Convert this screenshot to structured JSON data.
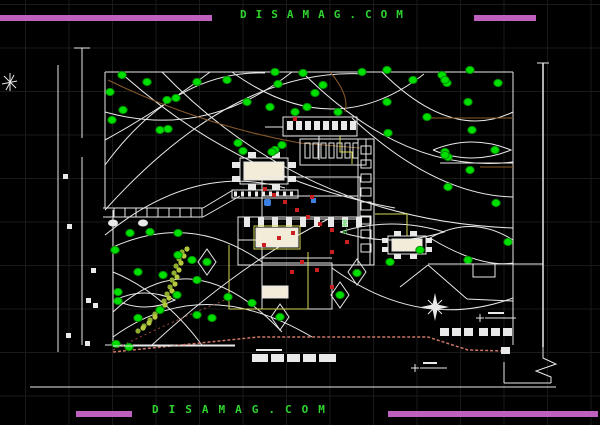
{
  "watermark": {
    "top_text": "DISAMAG.COM",
    "bottom_text": "DISAMAG.COM"
  },
  "labels": {
    "elevation_text": "0.00"
  },
  "colors": {
    "background": "#000000",
    "grid": "#1a1a1a",
    "line_white": "#e9e9e9",
    "magenta_bar": "#c060be",
    "watermark_green": "#2fd32f",
    "tree_green": "#00e000",
    "yellow_boundary": "#d8d855",
    "cream_fill": "#f2ecd8",
    "red_fixture": "#cc2020",
    "salmon_contour": "#cc7766",
    "brown_road": "#8b5a2b",
    "blue_fixture": "#3b7fe0"
  },
  "plan": {
    "trees": [
      [
        122,
        75
      ],
      [
        147,
        82
      ],
      [
        167,
        100
      ],
      [
        176,
        98
      ],
      [
        197,
        82
      ],
      [
        227,
        80
      ],
      [
        247,
        102
      ],
      [
        110,
        92
      ],
      [
        123,
        110
      ],
      [
        112,
        120
      ],
      [
        160,
        130
      ],
      [
        168,
        129
      ],
      [
        238,
        143
      ],
      [
        270,
        107
      ],
      [
        275,
        72
      ],
      [
        278,
        84
      ],
      [
        303,
        73
      ],
      [
        315,
        93
      ],
      [
        323,
        85
      ],
      [
        338,
        112
      ],
      [
        295,
        112
      ],
      [
        307,
        107
      ],
      [
        362,
        72
      ],
      [
        387,
        70
      ],
      [
        387,
        102
      ],
      [
        413,
        80
      ],
      [
        427,
        117
      ],
      [
        442,
        75
      ],
      [
        447,
        83
      ],
      [
        388,
        133
      ],
      [
        445,
        152
      ],
      [
        448,
        157
      ],
      [
        282,
        145
      ],
      [
        275,
        150
      ],
      [
        470,
        70
      ],
      [
        445,
        80
      ],
      [
        498,
        83
      ],
      [
        468,
        102
      ],
      [
        472,
        130
      ],
      [
        445,
        155
      ],
      [
        495,
        150
      ],
      [
        470,
        170
      ],
      [
        448,
        187
      ],
      [
        496,
        203
      ],
      [
        508,
        242
      ],
      [
        243,
        151
      ],
      [
        272,
        152
      ],
      [
        357,
        273
      ],
      [
        340,
        295
      ],
      [
        280,
        317
      ],
      [
        252,
        303
      ],
      [
        390,
        262
      ],
      [
        420,
        250
      ],
      [
        468,
        260
      ],
      [
        130,
        233
      ],
      [
        150,
        232
      ],
      [
        178,
        233
      ],
      [
        115,
        250
      ],
      [
        138,
        272
      ],
      [
        163,
        275
      ],
      [
        118,
        292
      ],
      [
        118,
        301
      ],
      [
        138,
        318
      ],
      [
        178,
        255
      ],
      [
        192,
        260
      ],
      [
        177,
        295
      ],
      [
        197,
        280
      ],
      [
        207,
        262
      ],
      [
        228,
        297
      ],
      [
        197,
        315
      ],
      [
        212,
        318
      ],
      [
        116,
        344
      ],
      [
        129,
        347
      ],
      [
        160,
        310
      ]
    ],
    "red_fixtures": [
      [
        263,
        187
      ],
      [
        272,
        193
      ],
      [
        283,
        200
      ],
      [
        295,
        208
      ],
      [
        306,
        215
      ],
      [
        318,
        222
      ],
      [
        330,
        228
      ],
      [
        291,
        231
      ],
      [
        277,
        236
      ],
      [
        262,
        243
      ],
      [
        300,
        260
      ],
      [
        315,
        268
      ],
      [
        290,
        270
      ],
      [
        330,
        250
      ],
      [
        345,
        240
      ],
      [
        293,
        117
      ],
      [
        330,
        285
      ],
      [
        310,
        195
      ]
    ],
    "stepping_stones": [
      [
        182,
        252
      ],
      [
        187,
        249
      ],
      [
        179,
        259
      ],
      [
        184,
        256
      ],
      [
        176,
        266
      ],
      [
        181,
        263
      ],
      [
        174,
        273
      ],
      [
        179,
        270
      ],
      [
        172,
        280
      ],
      [
        177,
        277
      ],
      [
        170,
        287
      ],
      [
        175,
        284
      ],
      [
        167,
        294
      ],
      [
        172,
        291
      ],
      [
        164,
        301
      ],
      [
        169,
        298
      ],
      [
        160,
        308
      ],
      [
        165,
        305
      ],
      [
        155,
        314
      ],
      [
        160,
        311
      ],
      [
        150,
        320
      ],
      [
        155,
        317
      ],
      [
        144,
        326
      ],
      [
        149,
        323
      ],
      [
        138,
        331
      ],
      [
        143,
        328
      ]
    ],
    "parking_stalls": [
      [
        440,
        328
      ],
      [
        452,
        328
      ],
      [
        464,
        328
      ],
      [
        479,
        328
      ],
      [
        491,
        328
      ],
      [
        503,
        328
      ]
    ],
    "dim_marks": [
      [
        63,
        174
      ],
      [
        67,
        224
      ],
      [
        91,
        268
      ],
      [
        86,
        298
      ],
      [
        93,
        303
      ],
      [
        66,
        333
      ],
      [
        85,
        341
      ]
    ]
  }
}
